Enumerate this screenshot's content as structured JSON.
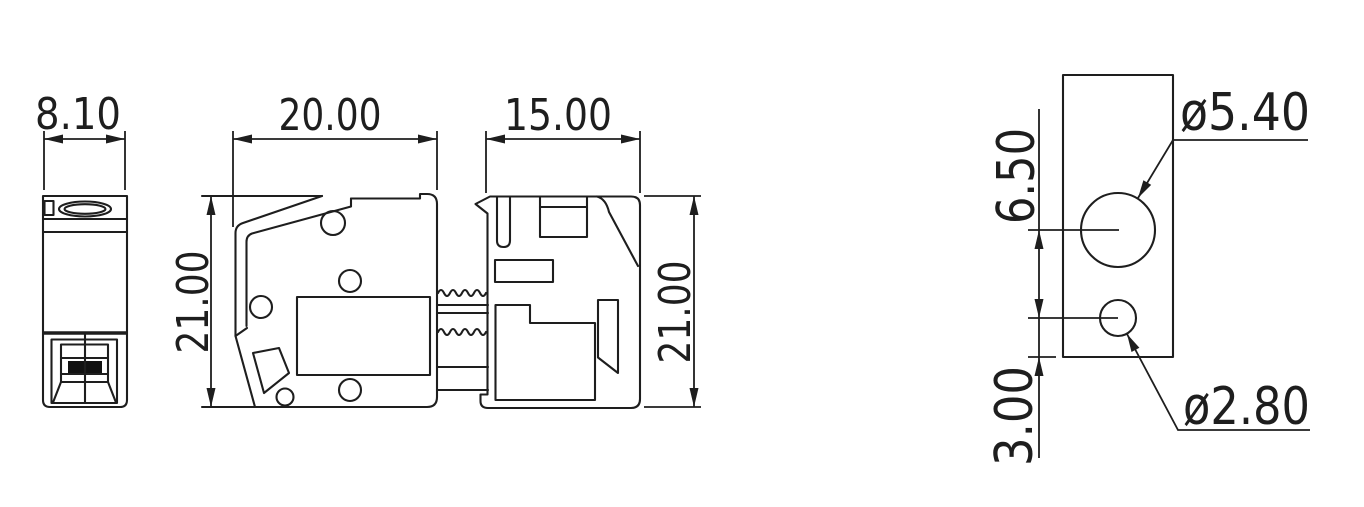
{
  "drawing": {
    "type": "mechanical-dimension-drawing",
    "background_color": "#ffffff",
    "line_color": "#1e1e1e",
    "views": [
      "front-view",
      "side-view-body",
      "side-view-cap",
      "hole-detail-view"
    ]
  },
  "dimensions": {
    "front_width": "8.10",
    "body_width": "20.00",
    "cap_width": "15.00",
    "body_height": "21.00",
    "cap_height": "21.00",
    "hole_center_spacing": "6.50",
    "small_hole_bottom_offset": "3.00",
    "large_hole_diameter": "ø5.40",
    "small_hole_diameter": "ø2.80"
  }
}
